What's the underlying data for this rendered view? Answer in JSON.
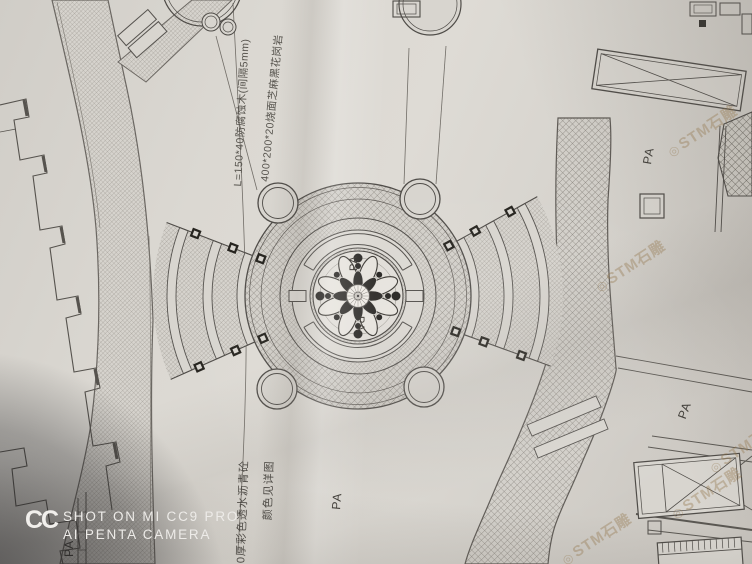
{
  "scene": {
    "description": "Photograph of a creased landscape architecture plan drawing",
    "paper_color": "#d8d5cf",
    "ink_color": "#4f4c48"
  },
  "plan": {
    "annotations": {
      "wood_deck": "L=150*40防腐蚀木(间隔5mm)",
      "granite_paving": "400*200*20烧面芝麻黑花岗岩",
      "permeable_asphalt": "50厚彩色透水沥青砼",
      "color_note": "颜色见详图"
    },
    "labels": {
      "planting_area": "PA"
    }
  },
  "watermarks": {
    "stone_seal": {
      "logo": "◎",
      "text": "STM石雕",
      "color": "rgba(148,117,76,0.38)"
    },
    "camera": {
      "logo": "CC",
      "line1": "SHOT ON MI CC9 PRO",
      "line2": "AI PENTA CAMERA",
      "text_color": "#edebe8"
    }
  }
}
